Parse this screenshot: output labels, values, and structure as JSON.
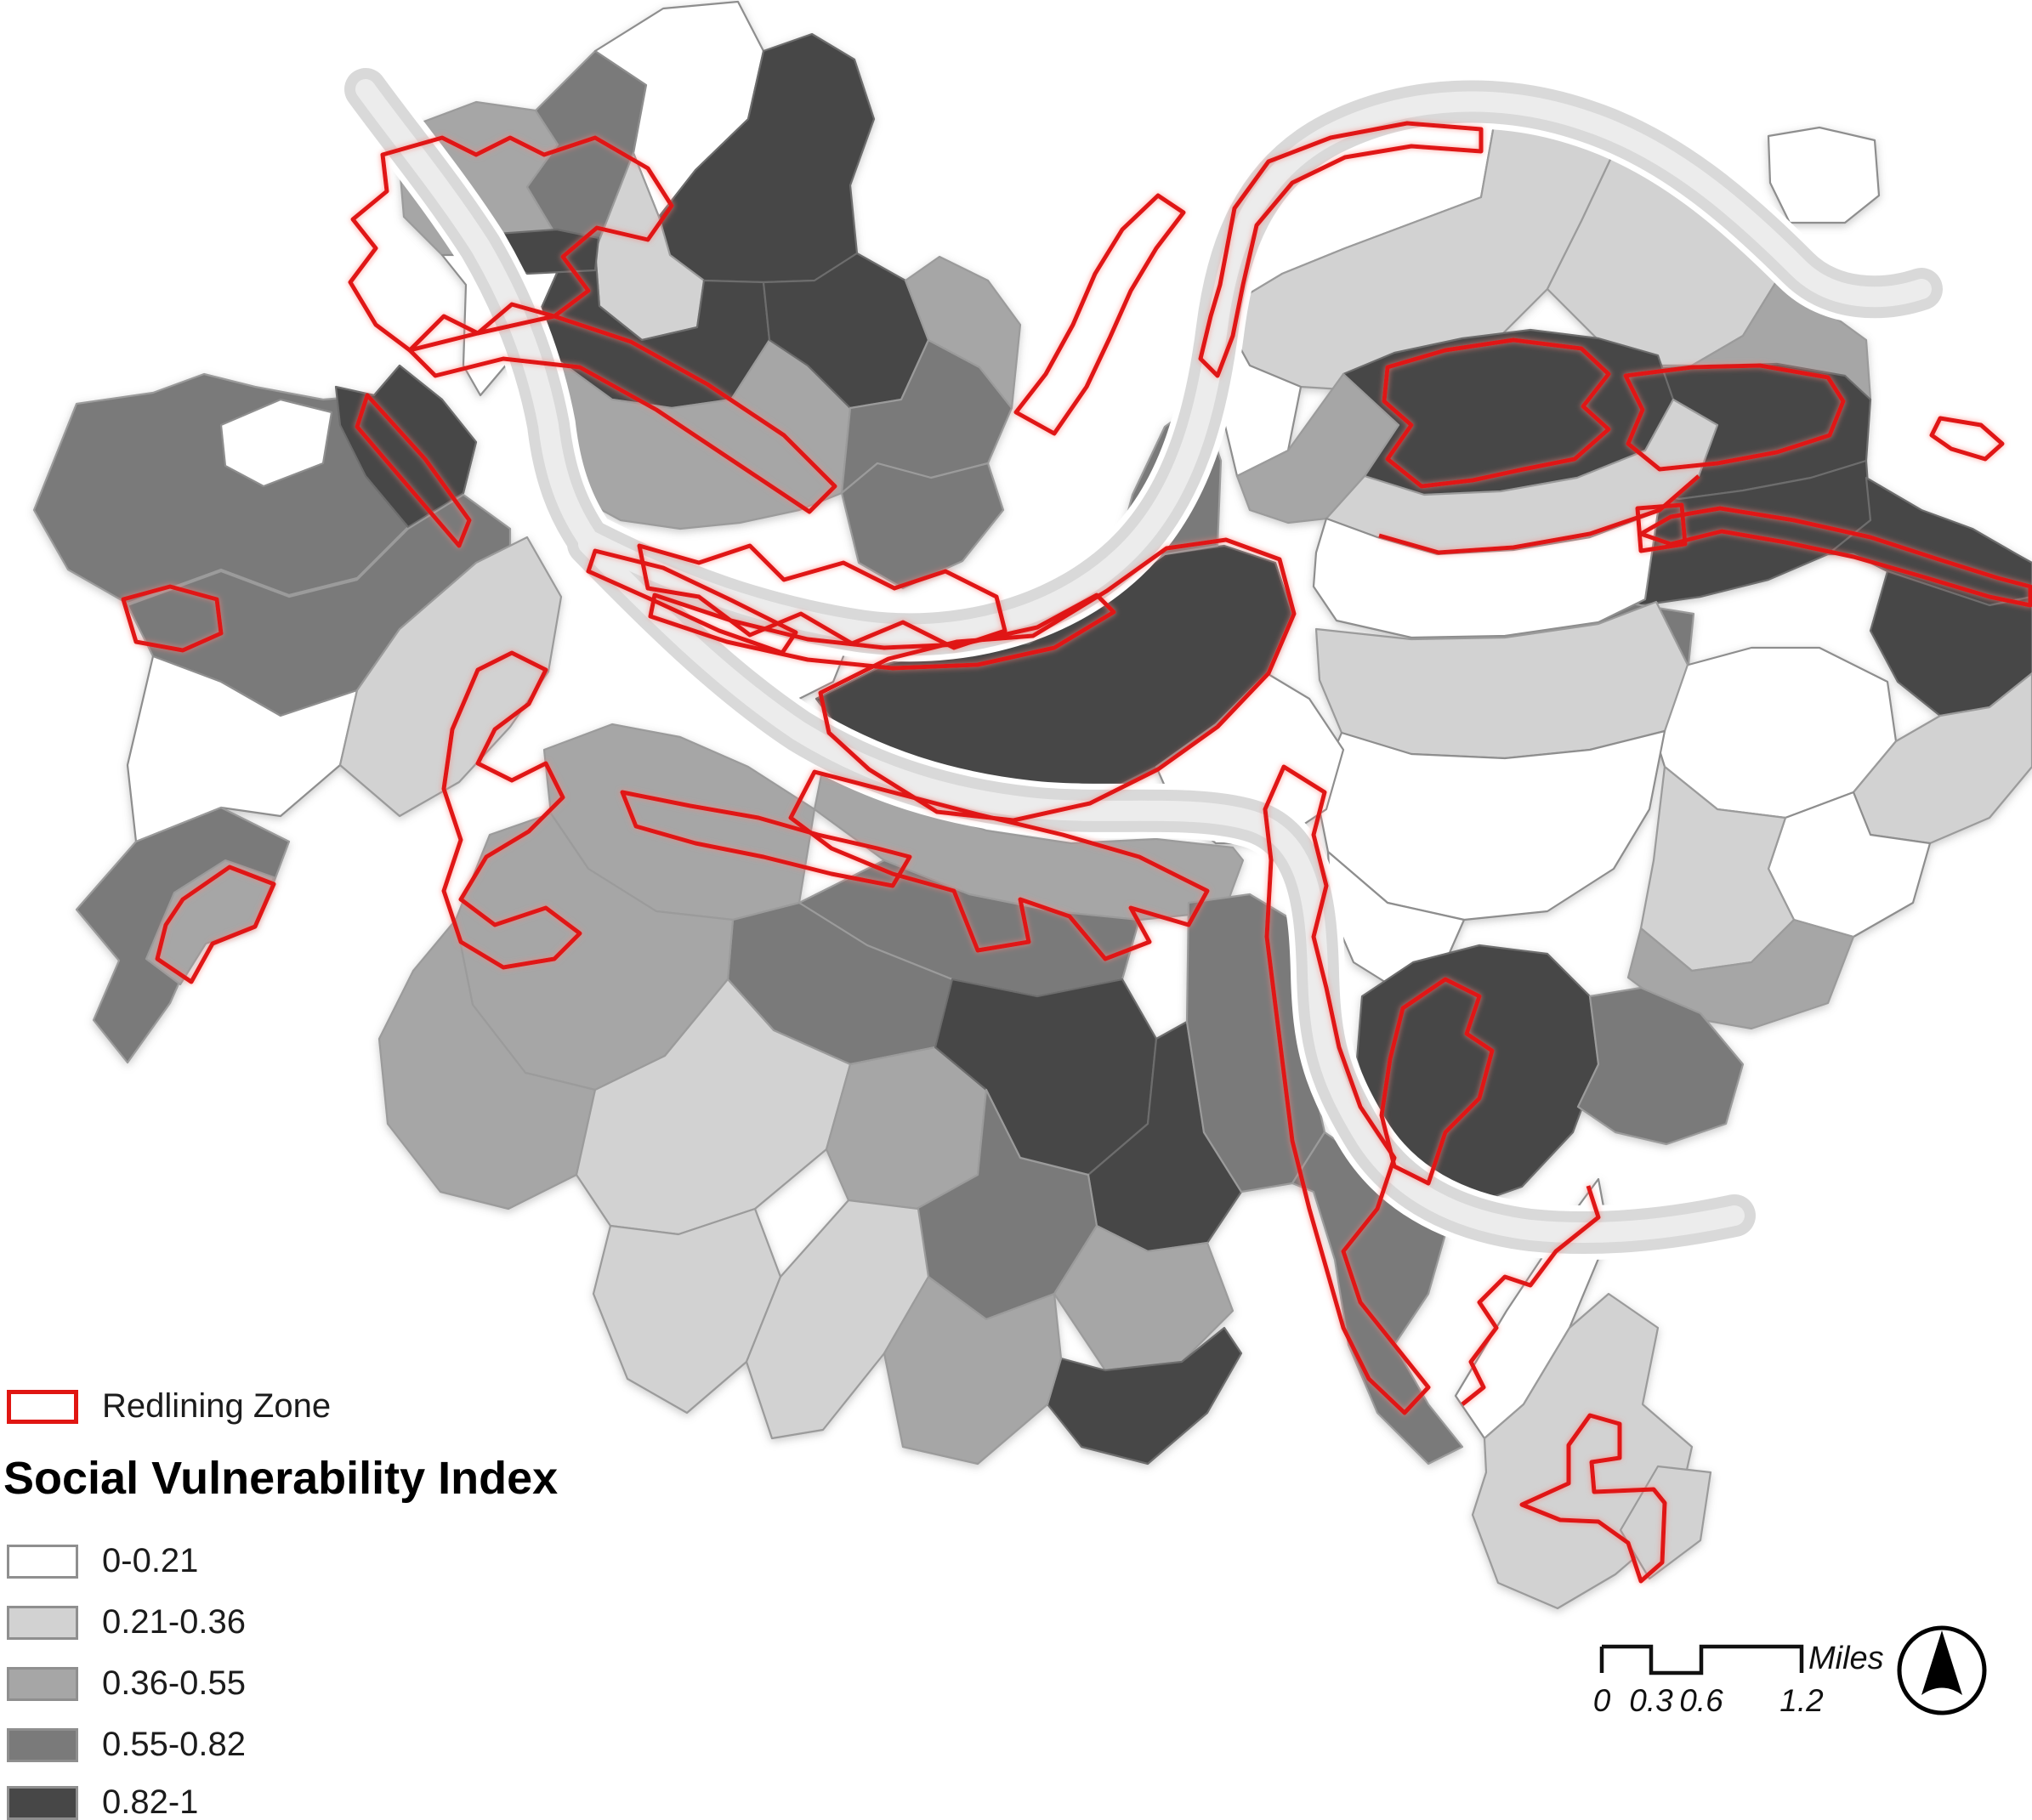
{
  "legend": {
    "redlining": {
      "label": "Redlining Zone",
      "color": "#e01612"
    },
    "title": "Social Vulnerability Index",
    "classes": [
      {
        "range": "0-0.21",
        "color": "#ffffff"
      },
      {
        "range": "0.21-0.36",
        "color": "#d2d2d2"
      },
      {
        "range": "0.36-0.55",
        "color": "#a6a6a6"
      },
      {
        "range": "0.55-0.82",
        "color": "#7a7a7a"
      },
      {
        "range": "0.82-1",
        "color": "#474747"
      }
    ]
  },
  "scalebar": {
    "ticks": [
      "0",
      "0.3",
      "0.6",
      "1.2"
    ],
    "unit": "Miles"
  },
  "north_arrow": {
    "icon": "north-arrow-icon"
  },
  "colors": {
    "river": "#d9d9d9",
    "river_core": "#ececec",
    "tract_border": "#9b9b9b",
    "background": "#ffffff"
  }
}
